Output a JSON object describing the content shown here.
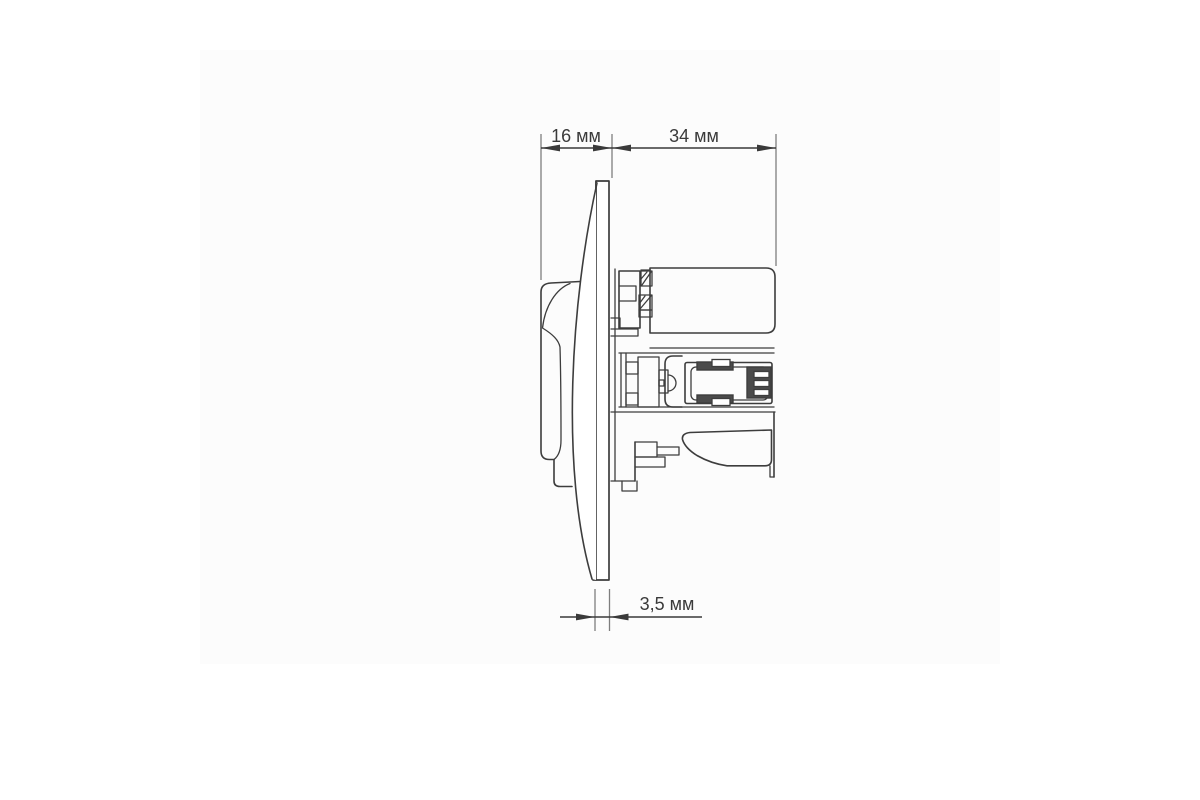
{
  "page": {
    "background_color": "#ffffff",
    "canvas_color": "#fcfcfc"
  },
  "drawing": {
    "line_color": "#3d3d3d",
    "extension_line_color": "#7e7e7e",
    "dark_fill_color": "#4b4b4b",
    "dimensions": {
      "front_projection": {
        "label": "16 мм",
        "value": 16,
        "unit": "мм"
      },
      "mounting_depth": {
        "label": "34 мм",
        "value": 34,
        "unit": "мм"
      },
      "faceplate_thickness": {
        "label": "3,5 мм",
        "value": 3.5,
        "unit": "мм"
      }
    }
  }
}
